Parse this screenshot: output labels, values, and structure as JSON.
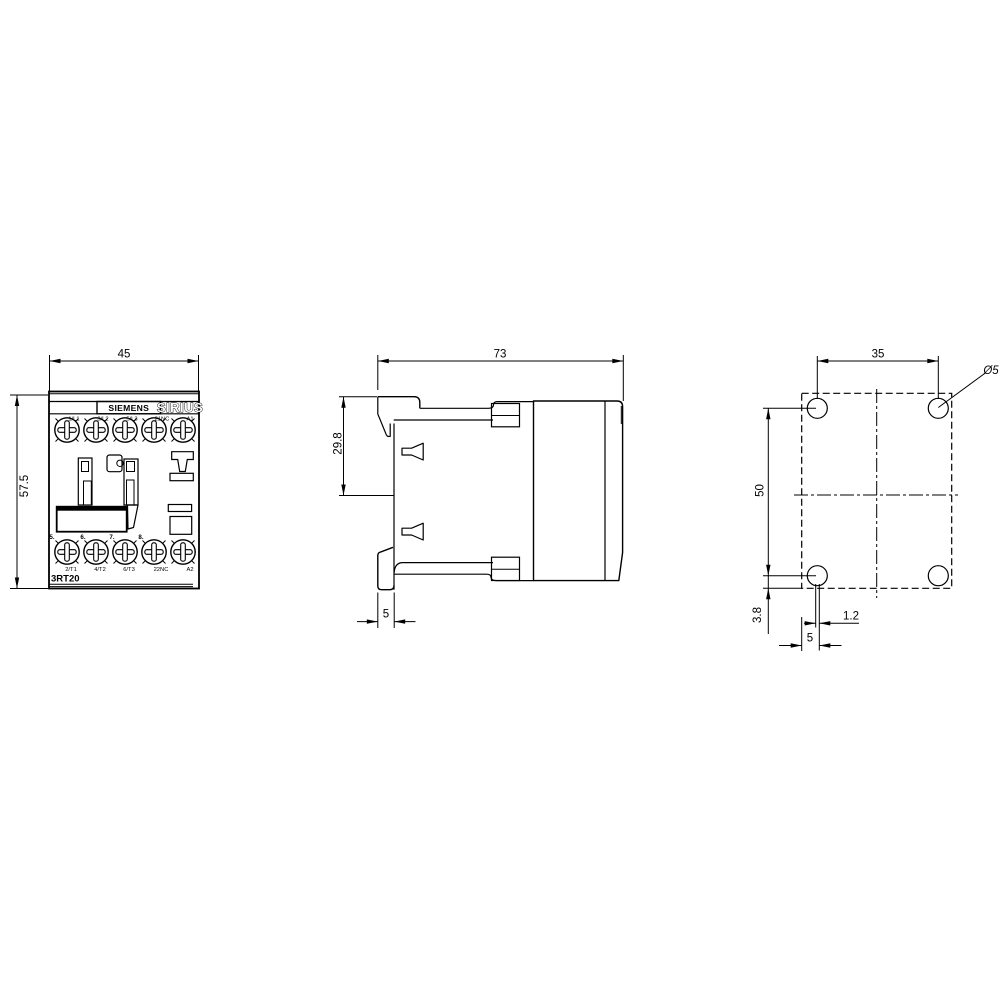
{
  "drawing": {
    "title": "contactor-dimension-drawing",
    "colors": {
      "line": "#000000",
      "background": "#ffffff"
    },
    "front": {
      "brand": "SIEMENS",
      "series": "SIRIUS",
      "model": "3RT20",
      "dim_width": "45",
      "dim_height": "57.5",
      "terminals_top": [
        "1/L1",
        "3/L2",
        "5/L3",
        "21NC",
        "A1"
      ],
      "terminals_bottom": [
        "2/T1",
        "4/T2",
        "6/T3",
        "22NC",
        "A2"
      ],
      "position_markers": [
        "5.",
        "6.",
        "7.",
        "8."
      ]
    },
    "side": {
      "dim_depth": "73",
      "dim_rail_offset": "29.8",
      "dim_foot_width": "5"
    },
    "mount": {
      "dim_hole_spacing_h": "35",
      "dim_hole_spacing_v": "50",
      "dim_bottom_offset": "3.8",
      "dim_center_offset": "1.2",
      "dim_edge_offset": "5",
      "hole_diameter": "Ø5"
    }
  }
}
